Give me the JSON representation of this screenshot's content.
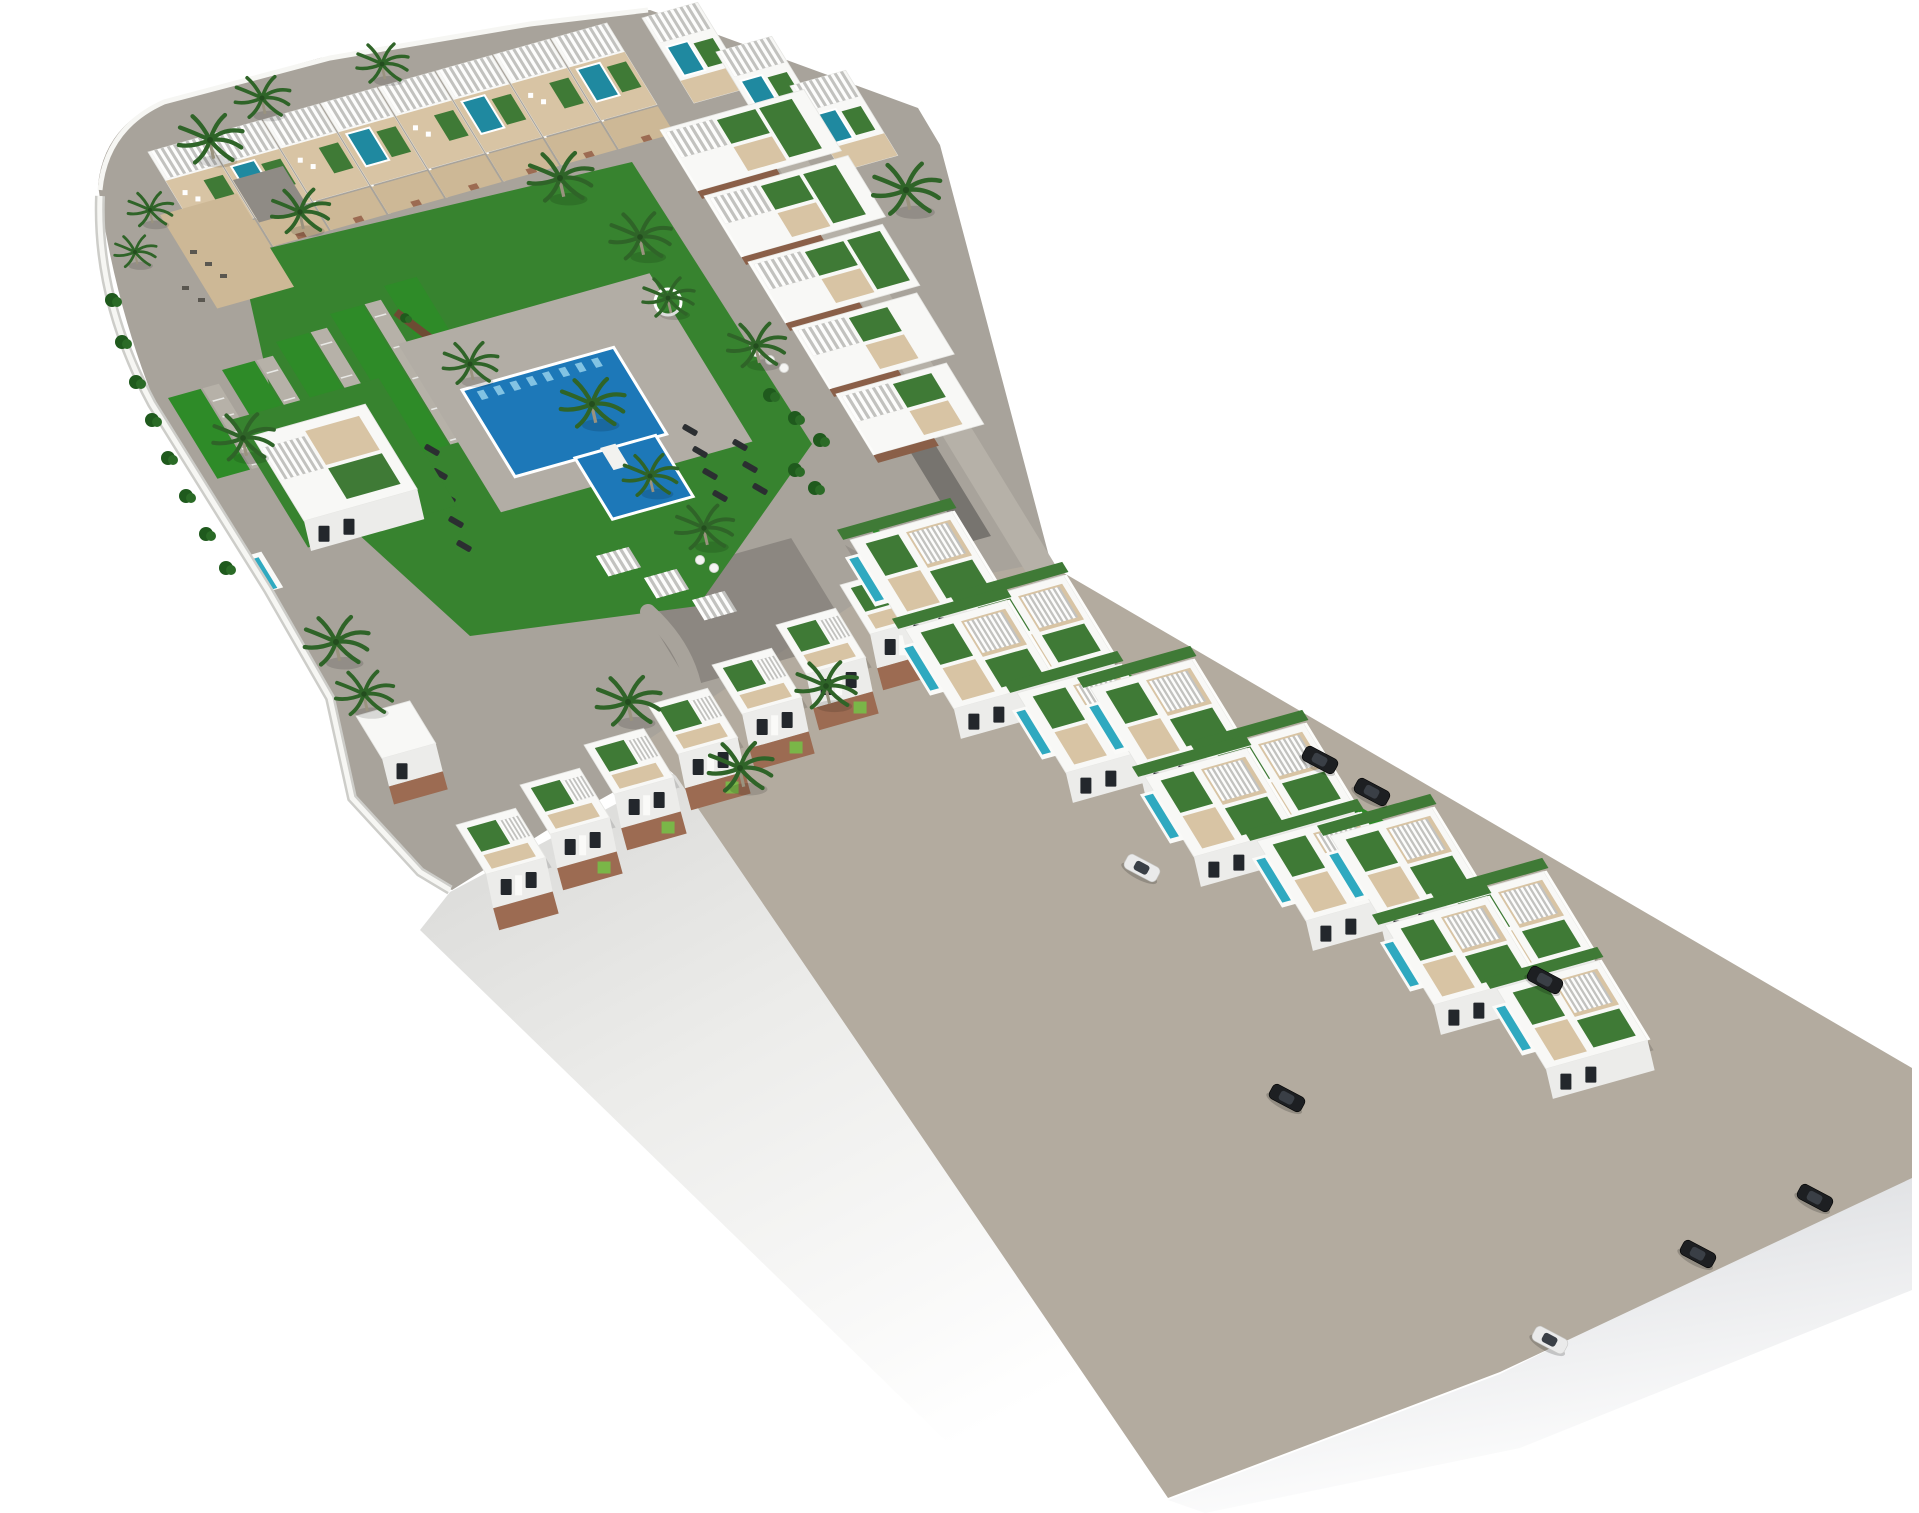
{
  "meta": {
    "title": "Aerial 3D masterplan rendering of a white Mediterranean residential complex with communal pool courtyard, rooftop terraces, villa clusters and parked cars on a white background",
    "render_type": "architectural-site-plan-3d-render",
    "background": "#ffffff"
  },
  "palette": {
    "road": "#a8a39b",
    "road_light": "#b6b1a8",
    "road_warm": "#b3ab9f",
    "road_shadow": "#6f6c67",
    "plinth_mid": "#d9d9d7",
    "plinth_light": "#f3f3f1",
    "grass": "#37832f",
    "grass_strip": "#2e8b28",
    "grass_lime": "#7ab648",
    "roofgarden": "#3f7a36",
    "hedge": "#1f5a1d",
    "stone_hedge": "#6d4b33",
    "pool_blue": "#1d78b8",
    "pool_light": "#8ecbe8",
    "pool_teal": "#2fa9c0",
    "roofpool": "#1f89a0",
    "deck": "#d8c4a4",
    "patio": "#cdb896",
    "brick": "#9c6b52",
    "wood": "#8a5f48",
    "bldg_top": "#f8f8f6",
    "bldg_face": "#ececea",
    "wall_white": "#fcfcfa",
    "window": "#23272c",
    "pergola": "#fdfdfc",
    "pergola_gap": "#c2c2bf",
    "palm": "#2f6428",
    "trunk": "#9a937f",
    "car_dark": "#1d1f22",
    "car_white": "#eaeaea",
    "car_glass": "#3a3f46",
    "slate_roof": "#8f8b85"
  },
  "site": {
    "main_block": {
      "label": "main apartment block around communal pool courtyard",
      "top_row_units": 8,
      "upper_right_step_units": 3,
      "wing_units": 5,
      "bottom_row_units": 7,
      "detached_houses": 1,
      "tail_houses": 1,
      "parking_lawn_strips": 5,
      "parking_lanes": 4,
      "cabanas": 3,
      "communal_pool": {
        "label": "communal swimming pool with kids pool",
        "main_pools": 1,
        "attached_pools": 1
      },
      "sun_loungers": 12,
      "round_loungers": 5
    },
    "villa_strip": {
      "label": "diagonal street strip with stepped villa clusters",
      "clusters": 3,
      "villas_per_cluster": 4,
      "lap_pools_per_villa": 1,
      "hedge_bands": 2
    },
    "vehicles": {
      "cars_total": 8,
      "dark_cars": 6,
      "white_cars": 2
    },
    "vegetation": {
      "palm_trees": 21,
      "bushes": 18
    }
  }
}
